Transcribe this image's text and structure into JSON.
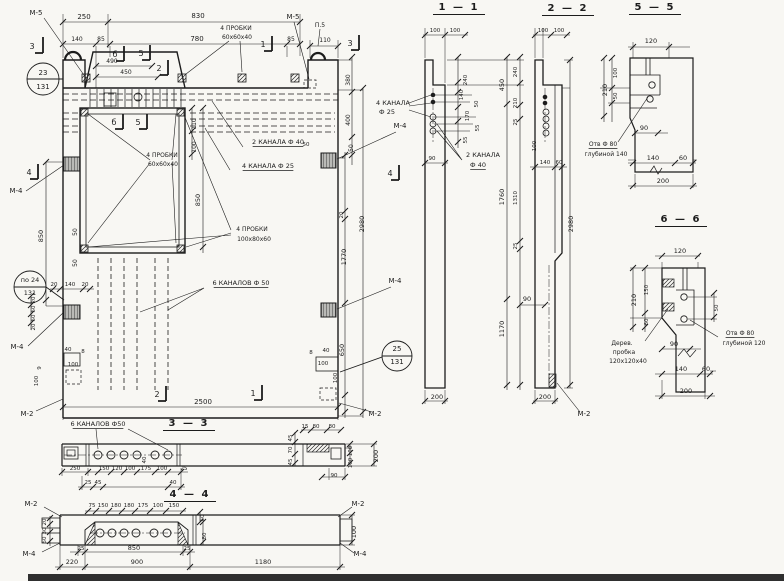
{
  "sections": {
    "s1_1": "1 — 1",
    "s2_2": "2 — 2",
    "s5_5": "5 — 5",
    "s6_6": "6 — 6",
    "s3_3": "3 — 3",
    "s4_4": "4 — 4"
  },
  "callouts": {
    "plugs_small": "4 ПРОБКИ 60х60х40",
    "plugs_large": "4 ПРОБКИ 100х80х60",
    "channels_40": "2 КАНАЛА Ф 40",
    "channels_25": "4 КАНАЛА Ф 25",
    "channels_50": "6 КАНАЛОВ Ф 50",
    "hole_140": "Отв Ф 80 глубиной 140",
    "hole_120": "Отв Ф 80 глубиной 120",
    "wood_plug": "Дерев. пробка 120х120х40",
    "loop": "П.5"
  },
  "marks": [
    "М-2",
    "М-4",
    "М-5"
  ],
  "position_circles": [
    [
      "23",
      "131"
    ],
    [
      "по 24",
      "131"
    ],
    [
      "25",
      "131"
    ]
  ],
  "overall_dims": {
    "width": "2500",
    "height": "2980",
    "section_length": "1180"
  },
  "labels": [
    {
      "t": "М-5",
      "x": 36,
      "y": 15,
      "n": "mark-m5"
    },
    {
      "t": "250",
      "x": 84,
      "y": 19
    },
    {
      "t": "830",
      "x": 198,
      "y": 18
    },
    {
      "t": "140",
      "x": 77,
      "y": 41,
      "fs": 6
    },
    {
      "t": "85",
      "x": 101,
      "y": 41,
      "fs": 6
    },
    {
      "t": "780",
      "x": 197,
      "y": 41
    },
    {
      "t": "85",
      "x": 291,
      "y": 41,
      "fs": 6
    },
    {
      "t": "490",
      "x": 112,
      "y": 63,
      "fs": 6
    },
    {
      "t": "450",
      "x": 126,
      "y": 74,
      "fs": 6
    },
    {
      "t": "4 ПРОБКИ",
      "x": 236,
      "y": 30,
      "fs": 6
    },
    {
      "t": "60х60х40",
      "x": 237,
      "y": 39,
      "fs": 6
    },
    {
      "t": "М-5",
      "x": 293,
      "y": 19,
      "n": "mark-m5"
    },
    {
      "t": "П.5",
      "x": 320,
      "y": 27,
      "fs": 6
    },
    {
      "t": "110",
      "x": 325,
      "y": 42,
      "fs": 6
    },
    {
      "t": "380",
      "x": 350,
      "y": 80,
      "r": 1,
      "fs": 6
    },
    {
      "t": "400",
      "x": 350,
      "y": 120,
      "r": 1,
      "fs": 6
    },
    {
      "t": "50",
      "x": 353,
      "y": 148,
      "r": 1,
      "fs": 6
    },
    {
      "t": "4 КАНАЛА",
      "x": 393,
      "y": 105,
      "fs": 6.5
    },
    {
      "t": "Ф 25",
      "x": 387,
      "y": 114,
      "fs": 6.5
    },
    {
      "t": "М-4",
      "x": 400,
      "y": 128,
      "n": "mark-m4"
    },
    {
      "t": "2 КАНАЛА Ф 40",
      "x": 278,
      "y": 144,
      "u": 1,
      "fs": 6.5
    },
    {
      "t": "4 КАНАЛА Ф 25",
      "x": 268,
      "y": 168,
      "u": 1,
      "fs": 6.5
    },
    {
      "t": "4 ПРОБКИ",
      "x": 162,
      "y": 157,
      "fs": 6
    },
    {
      "t": "60х60х40",
      "x": 163,
      "y": 166,
      "fs": 6
    },
    {
      "t": "110",
      "x": 196,
      "y": 124,
      "r": 1,
      "fs": 6
    },
    {
      "t": "100",
      "x": 196,
      "y": 147,
      "r": 1,
      "fs": 6
    },
    {
      "t": "850",
      "x": 200,
      "y": 200,
      "r": 1,
      "fs": 6.5
    },
    {
      "t": "4 ПРОБКИ",
      "x": 252,
      "y": 231,
      "fs": 6
    },
    {
      "t": "100х80х60",
      "x": 254,
      "y": 241,
      "fs": 6
    },
    {
      "t": "6 КАНАЛОВ Ф 50",
      "x": 241,
      "y": 285,
      "u": 1,
      "fs": 6.5
    },
    {
      "t": "М-4",
      "x": 16,
      "y": 193,
      "n": "mark-m4"
    },
    {
      "t": "850",
      "x": 43,
      "y": 236,
      "r": 1,
      "fs": 6.5
    },
    {
      "t": "50",
      "x": 77,
      "y": 232,
      "r": 1,
      "fs": 6
    },
    {
      "t": "50",
      "x": 77,
      "y": 263,
      "r": 1,
      "fs": 6
    },
    {
      "t": "по 24",
      "x": 30,
      "y": 282,
      "fs": 6.5
    },
    {
      "t": "131",
      "x": 30,
      "y": 295,
      "fs": 6.5
    },
    {
      "t": "20",
      "x": 54,
      "y": 286,
      "fs": 5.5
    },
    {
      "t": "140",
      "x": 70,
      "y": 286,
      "fs": 5.5
    },
    {
      "t": "20",
      "x": 85,
      "y": 286,
      "fs": 5.5
    },
    {
      "t": "20",
      "x": 35,
      "y": 300,
      "r": 1,
      "fs": 5.5
    },
    {
      "t": "50",
      "x": 35,
      "y": 309,
      "r": 1,
      "fs": 5.5
    },
    {
      "t": "50",
      "x": 35,
      "y": 318,
      "r": 1,
      "fs": 5.5
    },
    {
      "t": "20",
      "x": 35,
      "y": 327,
      "r": 1,
      "fs": 5.5
    },
    {
      "t": "М-4",
      "x": 17,
      "y": 349,
      "n": "mark-m4"
    },
    {
      "t": "40",
      "x": 68,
      "y": 351,
      "fs": 5.5
    },
    {
      "t": "8",
      "x": 83,
      "y": 353,
      "fs": 5.5
    },
    {
      "t": "100",
      "x": 73,
      "y": 366,
      "fs": 5.5
    },
    {
      "t": "9",
      "x": 41,
      "y": 368,
      "r": 1,
      "fs": 5.5
    },
    {
      "t": "100",
      "x": 38,
      "y": 381,
      "r": 1,
      "fs": 5.5
    },
    {
      "t": "М-2",
      "x": 27,
      "y": 416,
      "n": "mark-m2"
    },
    {
      "t": "2500",
      "x": 203,
      "y": 404
    },
    {
      "t": "23",
      "x": 43,
      "y": 75,
      "fs": 7
    },
    {
      "t": "131",
      "x": 43,
      "y": 89,
      "fs": 7
    },
    {
      "t": "50",
      "x": 306,
      "y": 146,
      "fs": 5.5
    },
    {
      "t": "20",
      "x": 343,
      "y": 215,
      "r": 1,
      "fs": 5.5
    },
    {
      "t": "1770",
      "x": 346,
      "y": 257,
      "r": 1,
      "fs": 6.5
    },
    {
      "t": "2980",
      "x": 364,
      "y": 224,
      "r": 1,
      "fs": 6.5
    },
    {
      "t": "М-4",
      "x": 395,
      "y": 283,
      "n": "mark-m4"
    },
    {
      "t": "650",
      "x": 344,
      "y": 350,
      "r": 1,
      "fs": 6.5
    },
    {
      "t": "8",
      "x": 311,
      "y": 354,
      "fs": 5.5
    },
    {
      "t": "40",
      "x": 326,
      "y": 352,
      "fs": 5.5
    },
    {
      "t": "100",
      "x": 323,
      "y": 365,
      "fs": 5.5
    },
    {
      "t": "100",
      "x": 337,
      "y": 378,
      "r": 1,
      "fs": 5.5
    },
    {
      "t": "25",
      "x": 397,
      "y": 351,
      "fs": 7
    },
    {
      "t": "131",
      "x": 397,
      "y": 364,
      "fs": 7
    },
    {
      "t": "М-2",
      "x": 375,
      "y": 416,
      "n": "mark-m2"
    },
    {
      "t": "3",
      "x": 32,
      "y": 49,
      "fs": 8,
      "n": "cut-mark"
    },
    {
      "t": "б",
      "x": 115,
      "y": 57,
      "fs": 8,
      "n": "cut-mark"
    },
    {
      "t": "5",
      "x": 141,
      "y": 56,
      "fs": 8,
      "n": "cut-mark"
    },
    {
      "t": "2",
      "x": 159,
      "y": 71,
      "fs": 8,
      "n": "cut-mark"
    },
    {
      "t": "1",
      "x": 263,
      "y": 47,
      "fs": 8,
      "n": "cut-mark"
    },
    {
      "t": "3",
      "x": 350,
      "y": 46,
      "fs": 8,
      "n": "cut-mark"
    },
    {
      "t": "б",
      "x": 114,
      "y": 125,
      "fs": 8,
      "n": "cut-mark"
    },
    {
      "t": "5",
      "x": 138,
      "y": 125,
      "fs": 8,
      "n": "cut-mark"
    },
    {
      "t": "4",
      "x": 29,
      "y": 175,
      "fs": 8,
      "n": "cut-mark"
    },
    {
      "t": "4",
      "x": 390,
      "y": 176,
      "fs": 8,
      "n": "cut-mark"
    },
    {
      "t": "2",
      "x": 157,
      "y": 397,
      "fs": 8,
      "n": "cut-mark"
    },
    {
      "t": "1",
      "x": 253,
      "y": 396,
      "fs": 8,
      "n": "cut-mark"
    },
    {
      "t": "100",
      "x": 435,
      "y": 32,
      "fs": 5.5
    },
    {
      "t": "100",
      "x": 455,
      "y": 32,
      "fs": 5.5
    },
    {
      "t": "240",
      "x": 467,
      "y": 80,
      "r": 1,
      "fs": 5.5
    },
    {
      "t": "140",
      "x": 463,
      "y": 95,
      "r": 1,
      "fs": 5.5
    },
    {
      "t": "50",
      "x": 478,
      "y": 104,
      "r": 1,
      "fs": 5.5
    },
    {
      "t": "170",
      "x": 469,
      "y": 116,
      "r": 1,
      "fs": 5.5
    },
    {
      "t": "55",
      "x": 479,
      "y": 128,
      "r": 1,
      "fs": 5.5
    },
    {
      "t": "55",
      "x": 467,
      "y": 140,
      "r": 1,
      "fs": 5.5
    },
    {
      "t": "90",
      "x": 432,
      "y": 160,
      "fs": 5.5
    },
    {
      "t": "2 КАНАЛА",
      "x": 483,
      "y": 157,
      "fs": 6.5
    },
    {
      "t": "Ф 40",
      "x": 478,
      "y": 167,
      "fs": 6.5,
      "u": 1
    },
    {
      "t": "200",
      "x": 437,
      "y": 399,
      "fs": 6.5
    },
    {
      "t": "240",
      "x": 517,
      "y": 72,
      "r": 1,
      "fs": 5.5
    },
    {
      "t": "450",
      "x": 504,
      "y": 85,
      "r": 1,
      "fs": 6.5
    },
    {
      "t": "210",
      "x": 517,
      "y": 103,
      "r": 1,
      "fs": 5.5
    },
    {
      "t": "25",
      "x": 517,
      "y": 122,
      "r": 1,
      "fs": 5.5
    },
    {
      "t": "1760",
      "x": 504,
      "y": 197,
      "r": 1,
      "fs": 6.5
    },
    {
      "t": "1310",
      "x": 517,
      "y": 198,
      "r": 1,
      "fs": 5.5
    },
    {
      "t": "25",
      "x": 517,
      "y": 246,
      "r": 1,
      "fs": 5.5
    },
    {
      "t": "1170",
      "x": 504,
      "y": 329,
      "r": 1,
      "fs": 6.5
    },
    {
      "t": "100",
      "x": 543,
      "y": 32,
      "fs": 5.5
    },
    {
      "t": "100",
      "x": 559,
      "y": 32,
      "fs": 5.5
    },
    {
      "t": "100",
      "x": 536,
      "y": 146,
      "r": 1,
      "fs": 5.5
    },
    {
      "t": "140",
      "x": 545,
      "y": 164,
      "fs": 5.5
    },
    {
      "t": "60",
      "x": 559,
      "y": 164,
      "fs": 5.5
    },
    {
      "t": "90",
      "x": 527,
      "y": 301,
      "fs": 6.5
    },
    {
      "t": "2980",
      "x": 573,
      "y": 224,
      "r": 1,
      "fs": 6.5
    },
    {
      "t": "200",
      "x": 545,
      "y": 399,
      "fs": 6.5
    },
    {
      "t": "М-2",
      "x": 584,
      "y": 416,
      "n": "mark-m2"
    },
    {
      "t": "120",
      "x": 651,
      "y": 43,
      "fs": 6.5
    },
    {
      "t": "100",
      "x": 617,
      "y": 73,
      "r": 1,
      "fs": 5.5
    },
    {
      "t": "210",
      "x": 607,
      "y": 90,
      "r": 1,
      "fs": 6.5
    },
    {
      "t": "50",
      "x": 617,
      "y": 96,
      "r": 1,
      "fs": 5.5
    },
    {
      "t": "90",
      "x": 644,
      "y": 130,
      "fs": 6.5
    },
    {
      "t": "140",
      "x": 653,
      "y": 160,
      "fs": 6.5
    },
    {
      "t": "60",
      "x": 683,
      "y": 160,
      "fs": 6.5
    },
    {
      "t": "200",
      "x": 663,
      "y": 183,
      "fs": 6.5
    },
    {
      "t": "Отв Ф 80",
      "x": 603,
      "y": 146,
      "fs": 6,
      "u": 1
    },
    {
      "t": "глубиной 140",
      "x": 606,
      "y": 156,
      "fs": 6
    },
    {
      "t": "120",
      "x": 680,
      "y": 253,
      "fs": 6.5
    },
    {
      "t": "150",
      "x": 648,
      "y": 290,
      "r": 1,
      "fs": 5.5
    },
    {
      "t": "210",
      "x": 636,
      "y": 300,
      "r": 1,
      "fs": 6.5
    },
    {
      "t": "60",
      "x": 648,
      "y": 322,
      "r": 1,
      "fs": 5.5
    },
    {
      "t": "50",
      "x": 718,
      "y": 308,
      "r": 1,
      "fs": 5.5
    },
    {
      "t": "90",
      "x": 674,
      "y": 346,
      "fs": 6.5
    },
    {
      "t": "140",
      "x": 681,
      "y": 371,
      "fs": 6.5
    },
    {
      "t": "60",
      "x": 706,
      "y": 371,
      "fs": 6.5
    },
    {
      "t": "200",
      "x": 686,
      "y": 393,
      "fs": 6.5
    },
    {
      "t": "Дерев.",
      "x": 622,
      "y": 345,
      "fs": 6
    },
    {
      "t": "пробка",
      "x": 624,
      "y": 354,
      "fs": 6
    },
    {
      "t": "120х120х40",
      "x": 628,
      "y": 363,
      "fs": 6
    },
    {
      "t": "Отв Ф 80",
      "x": 740,
      "y": 335,
      "fs": 6,
      "u": 1
    },
    {
      "t": "глубиной 120",
      "x": 744,
      "y": 345,
      "fs": 6
    },
    {
      "t": "6 КАНАЛОВ Ф50",
      "x": 98,
      "y": 426,
      "u": 1,
      "fs": 6.5
    },
    {
      "t": "250",
      "x": 75,
      "y": 470,
      "fs": 5.5
    },
    {
      "t": "150",
      "x": 104,
      "y": 470,
      "fs": 5.5
    },
    {
      "t": "120",
      "x": 117,
      "y": 470,
      "fs": 5.5
    },
    {
      "t": "100",
      "x": 130,
      "y": 470,
      "fs": 5.5
    },
    {
      "t": "175",
      "x": 146,
      "y": 470,
      "fs": 5.5
    },
    {
      "t": "100",
      "x": 162,
      "y": 470,
      "fs": 5.5
    },
    {
      "t": "25",
      "x": 184,
      "y": 470,
      "fs": 5.5
    },
    {
      "t": "25",
      "x": 88,
      "y": 484,
      "fs": 5.5
    },
    {
      "t": "45",
      "x": 98,
      "y": 484,
      "fs": 5.5
    },
    {
      "t": "40",
      "x": 173,
      "y": 484,
      "fs": 5.5
    },
    {
      "t": "40",
      "x": 146,
      "y": 460,
      "r": 1,
      "fs": 5.5
    },
    {
      "t": "15",
      "x": 305,
      "y": 428,
      "fs": 5.5
    },
    {
      "t": "80",
      "x": 316,
      "y": 428,
      "fs": 5.5
    },
    {
      "t": "80",
      "x": 332,
      "y": 428,
      "fs": 5.5
    },
    {
      "t": "45",
      "x": 292,
      "y": 438,
      "r": 1,
      "fs": 5.5
    },
    {
      "t": "70",
      "x": 292,
      "y": 450,
      "r": 1,
      "fs": 5.5
    },
    {
      "t": "45",
      "x": 292,
      "y": 462,
      "r": 1,
      "fs": 5.5
    },
    {
      "t": "90",
      "x": 334,
      "y": 477,
      "fs": 5.5
    },
    {
      "t": "100",
      "x": 352,
      "y": 451,
      "r": 1,
      "fs": 5.5
    },
    {
      "t": "100",
      "x": 352,
      "y": 463,
      "r": 1,
      "fs": 5.5
    },
    {
      "t": "200",
      "x": 378,
      "y": 456,
      "r": 1,
      "fs": 6.5
    },
    {
      "t": "М-2",
      "x": 31,
      "y": 506,
      "n": "mark-m2"
    },
    {
      "t": "М-2",
      "x": 358,
      "y": 506,
      "n": "mark-m2"
    },
    {
      "t": "М-4",
      "x": 29,
      "y": 556,
      "n": "mark-m4"
    },
    {
      "t": "М-4",
      "x": 360,
      "y": 556,
      "n": "mark-m4"
    },
    {
      "t": "75",
      "x": 92,
      "y": 507,
      "fs": 5.5
    },
    {
      "t": "150",
      "x": 103,
      "y": 507,
      "fs": 5.5
    },
    {
      "t": "180",
      "x": 116,
      "y": 507,
      "fs": 5.5
    },
    {
      "t": "180",
      "x": 129,
      "y": 507,
      "fs": 5.5
    },
    {
      "t": "175",
      "x": 143,
      "y": 507,
      "fs": 5.5
    },
    {
      "t": "100",
      "x": 158,
      "y": 507,
      "fs": 5.5
    },
    {
      "t": "150",
      "x": 174,
      "y": 507,
      "fs": 5.5
    },
    {
      "t": "60",
      "x": 204,
      "y": 518,
      "r": 1,
      "fs": 5.5
    },
    {
      "t": "80",
      "x": 206,
      "y": 536,
      "r": 1,
      "fs": 5.5
    },
    {
      "t": "20",
      "x": 46,
      "y": 522,
      "r": 1,
      "fs": 5.5
    },
    {
      "t": "30",
      "x": 46,
      "y": 531,
      "r": 1,
      "fs": 5.5
    },
    {
      "t": "50",
      "x": 46,
      "y": 540,
      "r": 1,
      "fs": 5.5
    },
    {
      "t": "25",
      "x": 81,
      "y": 550,
      "fs": 5.5
    },
    {
      "t": "850",
      "x": 134,
      "y": 550,
      "fs": 6.5
    },
    {
      "t": "25",
      "x": 187,
      "y": 550,
      "fs": 5.5
    },
    {
      "t": "220",
      "x": 72,
      "y": 564,
      "fs": 6.5
    },
    {
      "t": "900",
      "x": 137,
      "y": 564,
      "fs": 6.5
    },
    {
      "t": "1180",
      "x": 263,
      "y": 564,
      "fs": 6.5
    },
    {
      "t": "100",
      "x": 356,
      "y": 532,
      "r": 1,
      "fs": 6.5
    }
  ]
}
